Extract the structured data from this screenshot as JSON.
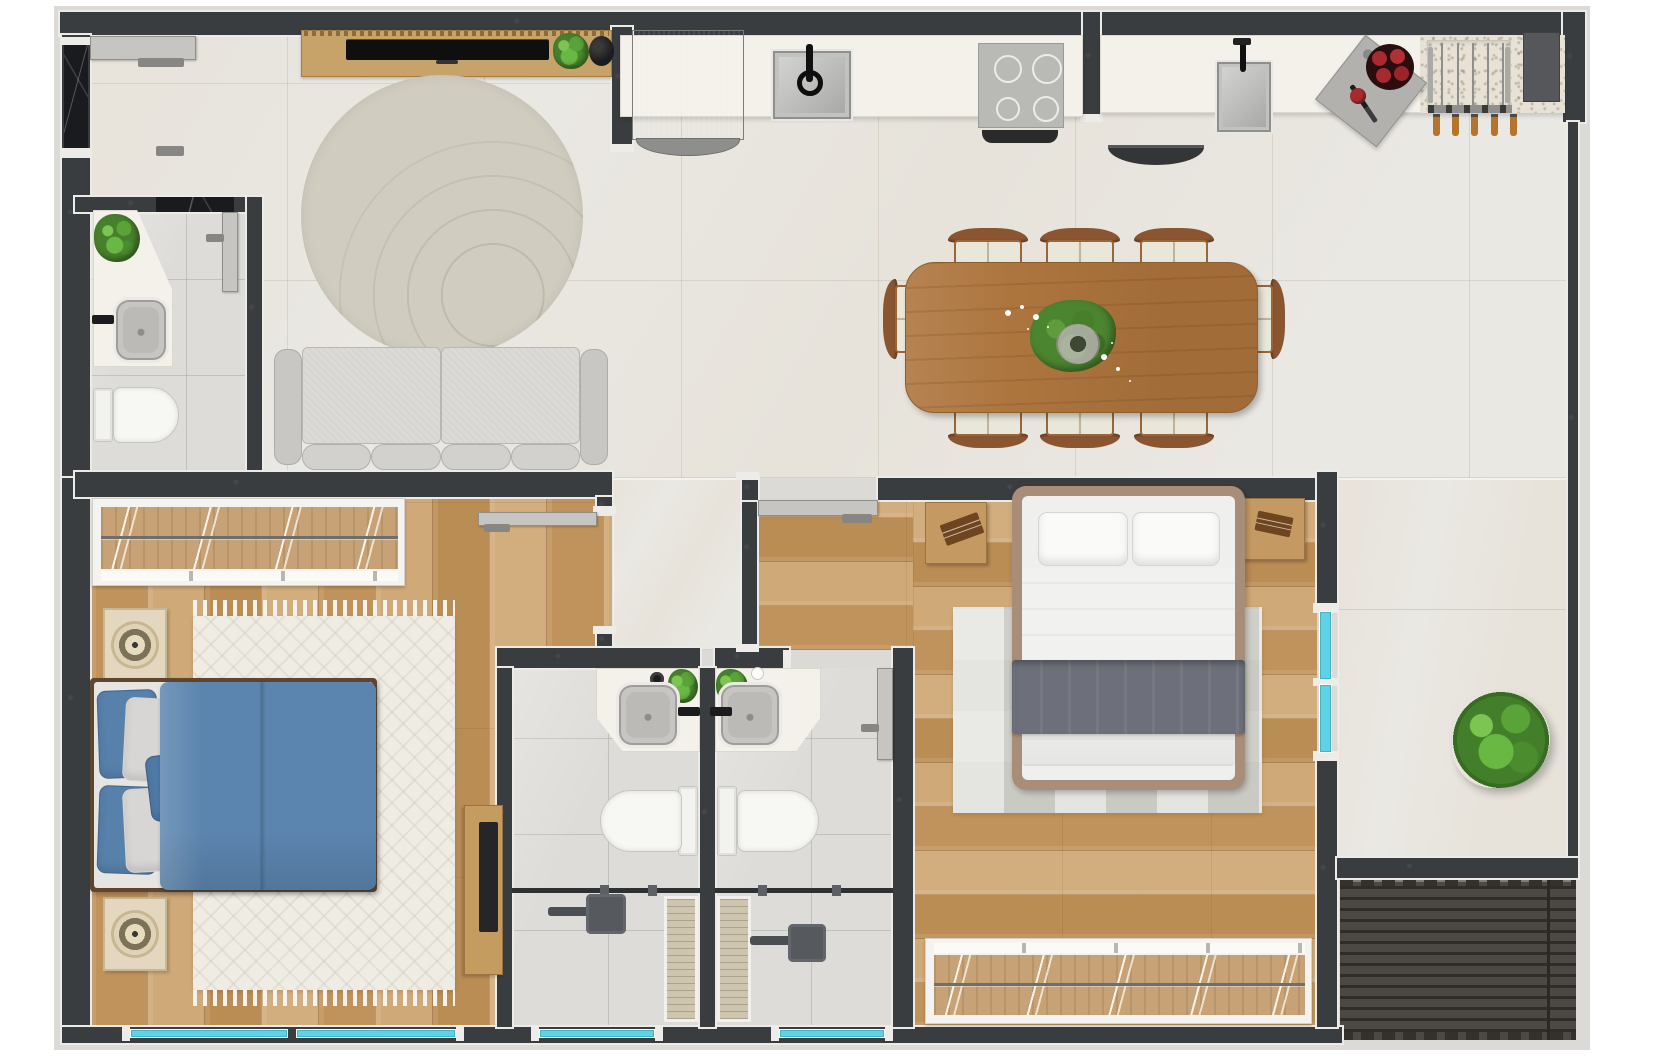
{
  "document": {
    "kind": "architectural-floor-plan-rendering",
    "view": "top-down",
    "text_labels": []
  },
  "rooms": [
    {
      "id": "living-room",
      "furniture": [
        "entry-door",
        "tv-console",
        "tv",
        "console-plant",
        "decor-bowl",
        "round-rug",
        "sofa"
      ]
    },
    {
      "id": "kitchen",
      "furniture": [
        "refrigerator",
        "countertop-left",
        "kitchen-sink",
        "cooktop",
        "vent-strip",
        "countertop-right",
        "prep-sink",
        "under-counter-appliance",
        "cutting-board",
        "tomatoes",
        "grill-rack",
        "hanging-utensils",
        "dark-panel"
      ]
    },
    {
      "id": "dining-area",
      "furniture": [
        "dining-table",
        "dining-chairs",
        "centerpiece-plant"
      ]
    },
    {
      "id": "powder-room",
      "furniture": [
        "vanity-counter",
        "vanity-sink",
        "faucet",
        "toilet",
        "plant",
        "door"
      ]
    },
    {
      "id": "hallway",
      "furniture": []
    },
    {
      "id": "bedroom-1",
      "furniture": [
        "wardrobe",
        "double-bed-blue",
        "nightstand",
        "nightstand",
        "area-rug",
        "desk",
        "laptop",
        "door"
      ]
    },
    {
      "id": "bathroom-1",
      "furniture": [
        "vanity-counter",
        "vanity-sink",
        "toilet",
        "shower-glass",
        "linear-drain",
        "shower-head",
        "plant",
        "door"
      ]
    },
    {
      "id": "bathroom-2",
      "furniture": [
        "vanity-counter",
        "vanity-sink",
        "toilet",
        "shower-glass",
        "linear-drain",
        "shower-head",
        "plant",
        "door"
      ]
    },
    {
      "id": "master-bedroom",
      "furniture": [
        "double-bed",
        "nightstand",
        "nightstand",
        "checkered-rug",
        "wardrobe",
        "door"
      ]
    },
    {
      "id": "terrace",
      "furniture": [
        "shrub"
      ]
    },
    {
      "id": "deck",
      "furniture": []
    }
  ],
  "counts": {
    "dining_chairs": 8,
    "bedrooms": 2,
    "bathrooms": 3,
    "bottom_window_panes": 4,
    "side_window_panes": 2,
    "hanging_utensils": 5,
    "cooktop_burners": 4
  },
  "palette": {
    "wall": "#3a3d40",
    "black_marble": "#191b1e",
    "floor_tile": "#eae8e3",
    "bath_tile": "#dedcd8",
    "wood_floor": "#c79e68",
    "table_wood": "#ad753e",
    "chair_wood": "#8a5530",
    "window_glass": "#5fd3e5",
    "deck_slats": "#45423e",
    "duvet_blue": "#5b84ae",
    "throw_gray": "#6d707a",
    "round_rug": "#d0ccc0",
    "bedroom_rug": "#efece4",
    "greenery": "#5aa338",
    "counter_white": "#f3f1ea",
    "fixture_white": "#f4f3f0"
  }
}
